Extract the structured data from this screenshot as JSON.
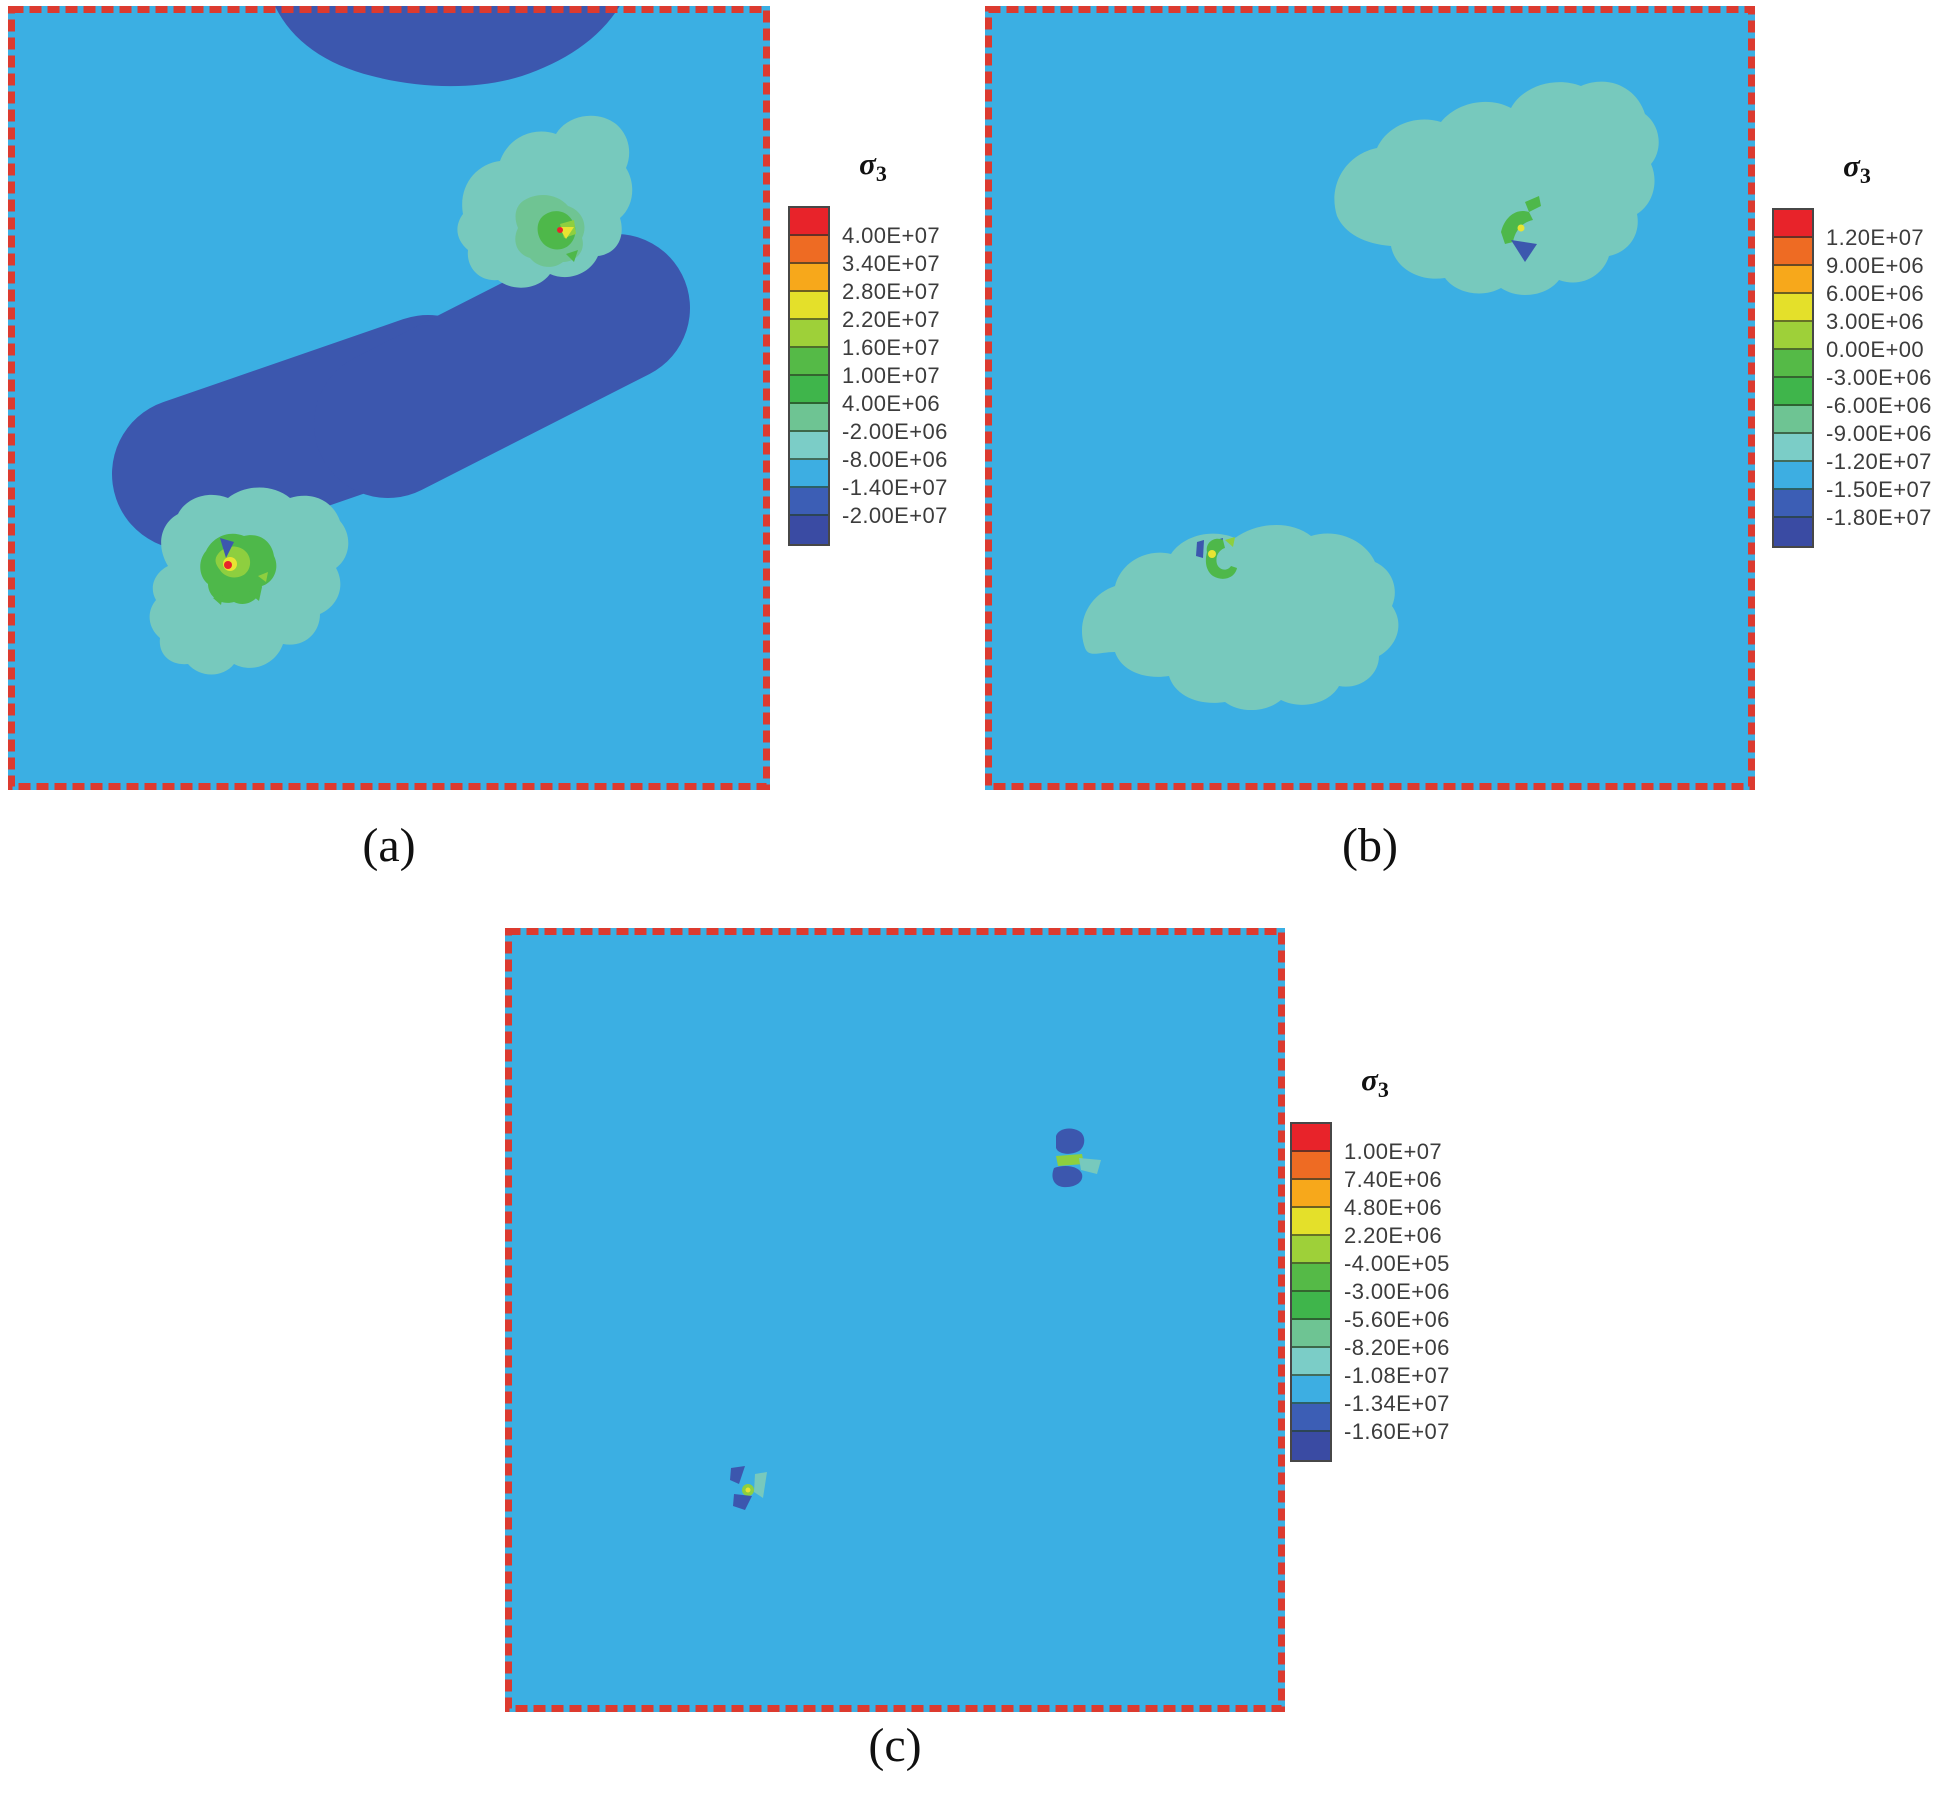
{
  "figure": {
    "background_color": "#ffffff",
    "border_color": "#dc3a2f",
    "field_colors": {
      "domain_background": "#3bafe3",
      "dark_blue_zone": "#3c57ae",
      "teal_zone": "#77c9bd",
      "sea_green": "#6fc493",
      "green": "#4eb84a",
      "light_green": "#8ecf3f",
      "yellow": "#e8e432",
      "red": "#e8242b"
    },
    "panels": [
      {
        "caption": "(a)",
        "legend": {
          "title": "σ",
          "subscript": "3",
          "labels": [
            "4.00E+07",
            "3.40E+07",
            "2.80E+07",
            "2.20E+07",
            "1.60E+07",
            "1.00E+07",
            "4.00E+06",
            "-2.00E+06",
            "-8.00E+06",
            "-1.40E+07",
            "-2.00E+07"
          ],
          "colors": [
            "#e8232a",
            "#ee6b23",
            "#f7a81b",
            "#e4e02a",
            "#9ed039",
            "#55ba47",
            "#3fb54b",
            "#6ec493",
            "#7bcdc7",
            "#3daee2",
            "#3c5eb5",
            "#3a4ba3"
          ]
        }
      },
      {
        "caption": "(b)",
        "legend": {
          "title": "σ",
          "subscript": "3",
          "labels": [
            "1.20E+07",
            "9.00E+06",
            "6.00E+06",
            "3.00E+06",
            "0.00E+00",
            "-3.00E+06",
            "-6.00E+06",
            "-9.00E+06",
            "-1.20E+07",
            "-1.50E+07",
            "-1.80E+07"
          ],
          "colors": [
            "#e8232a",
            "#ee6b23",
            "#f7a81b",
            "#e4e02a",
            "#9ed039",
            "#55ba47",
            "#3fb54b",
            "#6ec493",
            "#7bcdc7",
            "#3daee2",
            "#3c5eb5",
            "#3a4ba3"
          ]
        }
      },
      {
        "caption": "(c)",
        "legend": {
          "title": "σ",
          "subscript": "3",
          "labels": [
            "1.00E+07",
            "7.40E+06",
            "4.80E+06",
            "2.20E+06",
            "-4.00E+05",
            "-3.00E+06",
            "-5.60E+06",
            "-8.20E+06",
            "-1.08E+07",
            "-1.34E+07",
            "-1.60E+07"
          ],
          "colors": [
            "#e8232a",
            "#ee6b23",
            "#f7a81b",
            "#e4e02a",
            "#9ed039",
            "#55ba47",
            "#3fb54b",
            "#6ec493",
            "#7bcdc7",
            "#3daee2",
            "#3c5eb5",
            "#3a4ba3"
          ]
        }
      }
    ]
  },
  "chart_data": [
    {
      "type": "heatmap",
      "panel": "a",
      "title": "σ3",
      "legend_position": "right",
      "contour_levels": [
        40000000,
        34000000,
        28000000,
        22000000,
        16000000,
        10000000,
        4000000,
        -2000000,
        -8000000,
        -14000000,
        -20000000
      ],
      "level_labels": [
        "4.00E+07",
        "3.40E+07",
        "2.80E+07",
        "2.20E+07",
        "1.60E+07",
        "1.00E+07",
        "4.00E+06",
        "-2.00E+06",
        "-8.00E+06",
        "-1.40E+07",
        "-2.00E+07"
      ],
      "colors": [
        "#e8232a",
        "#ee6b23",
        "#f7a81b",
        "#e4e02a",
        "#9ed039",
        "#55ba47",
        "#3fb54b",
        "#6ec493",
        "#7bcdc7",
        "#3daee2",
        "#3c5eb5",
        "#3a4ba3"
      ],
      "field_description": "Square domain with red dashed boundary, mostly sky blue (-8.00E+06 to -1.40E+07). Dark blue lobe (-1.40E+07 to -2.00E+07) hangs from top edge; wide dark blue band runs diagonally from lower left to upper right. Light teal lobes (-2.00E+06 to -8.00E+06) around the two crack tips with green, yellow and red concentration spots at tips."
    },
    {
      "type": "heatmap",
      "panel": "b",
      "title": "σ3",
      "legend_position": "right",
      "contour_levels": [
        12000000,
        9000000,
        6000000,
        3000000,
        0,
        -3000000,
        -6000000,
        -9000000,
        -12000000,
        -15000000,
        -18000000
      ],
      "level_labels": [
        "1.20E+07",
        "9.00E+06",
        "6.00E+06",
        "3.00E+06",
        "0.00E+00",
        "-3.00E+06",
        "-6.00E+06",
        "-9.00E+06",
        "-1.20E+07",
        "-1.50E+07",
        "-1.80E+07"
      ],
      "colors": [
        "#e8232a",
        "#ee6b23",
        "#f7a81b",
        "#e4e02a",
        "#9ed039",
        "#55ba47",
        "#3fb54b",
        "#6ec493",
        "#7bcdc7",
        "#3daee2",
        "#3c5eb5",
        "#3a4ba3"
      ],
      "field_description": "Uniform sky blue domain with two two-lobed light teal zones (upper right and lower left crack tips); tiny green/yellow concentration points and small dark blue spots at each tip."
    },
    {
      "type": "heatmap",
      "panel": "c",
      "title": "σ3",
      "legend_position": "right",
      "contour_levels": [
        10000000,
        7400000,
        4800000,
        2200000,
        -400000,
        -3000000,
        -5600000,
        -8200000,
        -10800000,
        -13400000,
        -16000000
      ],
      "level_labels": [
        "1.00E+07",
        "7.40E+06",
        "4.80E+06",
        "2.20E+06",
        "-4.00E+05",
        "-3.00E+06",
        "-5.60E+06",
        "-8.20E+06",
        "-1.08E+07",
        "-1.34E+07",
        "-1.60E+07"
      ],
      "colors": [
        "#e8232a",
        "#ee6b23",
        "#f7a81b",
        "#e4e02a",
        "#9ed039",
        "#55ba47",
        "#3fb54b",
        "#6ec493",
        "#7bcdc7",
        "#3daee2",
        "#3c5eb5",
        "#3a4ba3"
      ],
      "field_description": "Nearly uniform sky blue domain; only two tiny residual concentration clusters (upper right and lower left), each made of small dark blue spots with a green/yellow point and teal sliver."
    }
  ]
}
